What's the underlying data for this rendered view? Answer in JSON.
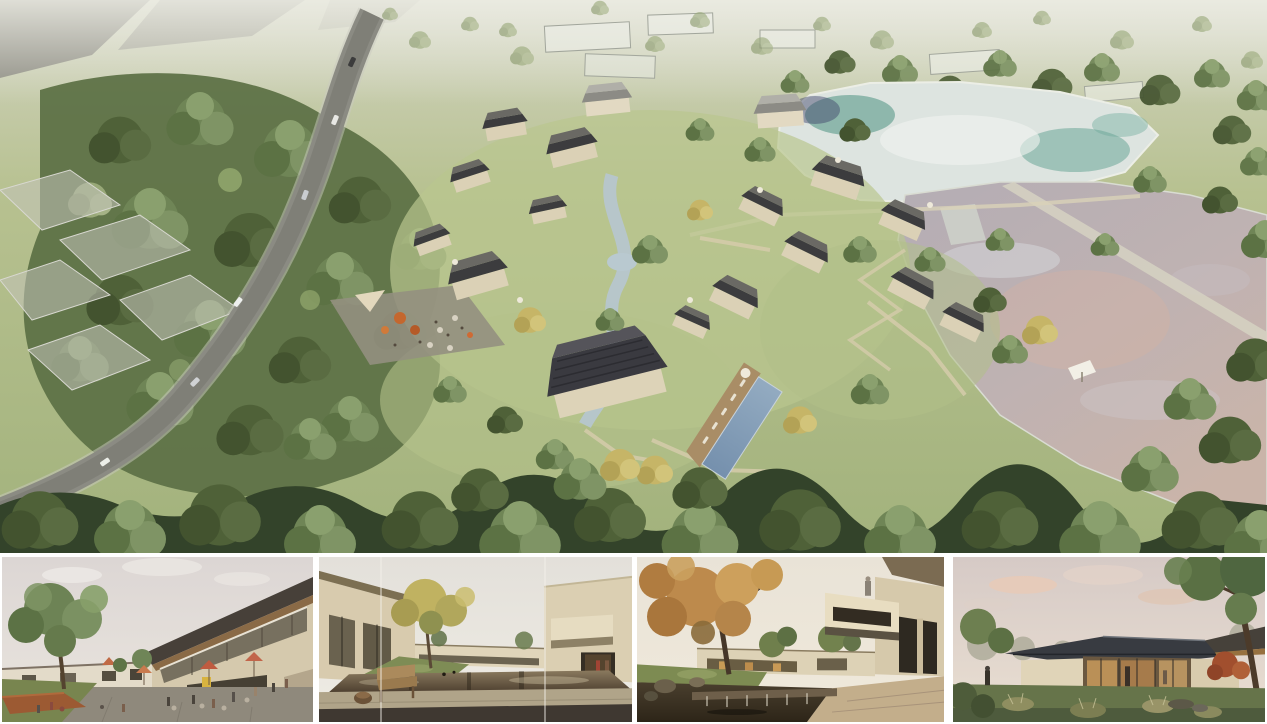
{
  "collage": {
    "label": "Architectural visualization board: aerial masterplan rendering of a lakeside courtyard-house village above four eye-level renderings",
    "panels": {
      "aerial": {
        "label": "Bird's-eye rendering of a village of pitched dark-roof houses beside two reflective ponds, with a curving access road, dense forest, winding stream, cafe plaza, lap pool with timber deck, and translucent context buildings in the hazy distance"
      },
      "thumbnails": [
        {
          "label": "Plaza street scene with lawn, large tree, corten planter, red cafe umbrellas, outdoor tables with people and a two-storey building with angled timber-soffit roof"
        },
        {
          "label": "Courtyard with reflecting pond, wooden bench and stump stool on a stone deck, golden tree, beige houses and two figures in a lit passage"
        },
        {
          "label": "Water court with large autumn tree, stone weir waterfall, rocks, warm-lit houses and a cantilevered white balcony with a person"
        },
        {
          "label": "Single-storey glass pavilion with dark hipped roof glowing warmly at dusk, framed by trees, red maple, tall grasses and rocks"
        }
      ]
    }
  },
  "palette": {
    "background_white": "#ffffff",
    "grass_light": "#b7c190",
    "grass_deep": "#8fa268",
    "forest_green": "#5e7247",
    "canopy_dark": "#33432a",
    "road_gray": "#8b8b83",
    "roof_dark": "#3a3a40",
    "wall_beige": "#dbd1b6",
    "stream_blue": "#b6c6cd",
    "pool_blue": "#7f9ab3",
    "upper_pond_teal": "#55998a",
    "lower_pond_mauve": "#b9b0b6",
    "pond_pink_reflection": "#d2b1a3",
    "autumn_orange": "#b5763d",
    "golden_tree": "#c0b261",
    "umbrella_red": "#bf5b40",
    "corten_rust": "#9c5a33",
    "sky_haze_pink": "#ded8d6",
    "interior_glow": "#c89c5e",
    "timber_soffit": "#8a6a46"
  }
}
